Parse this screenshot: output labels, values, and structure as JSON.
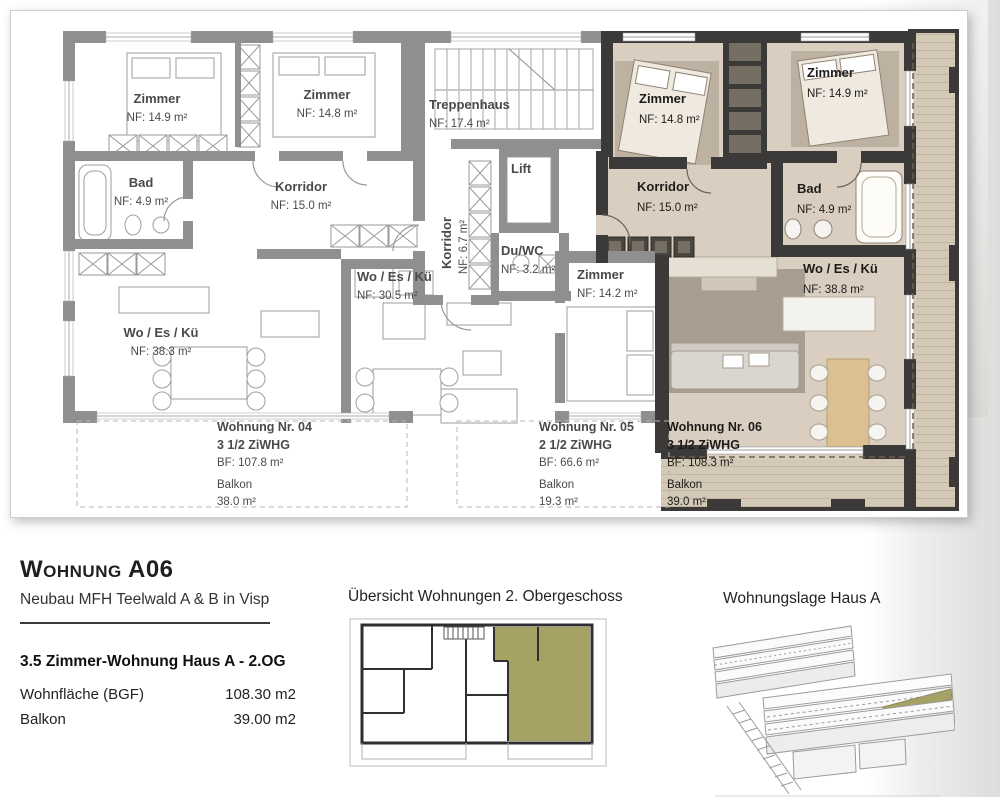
{
  "colors": {
    "wall_gray": "#8f8f8f",
    "wall_dark": "#3b3a38",
    "floor_tan": "#d9cec0",
    "olive": "#a6a263",
    "text_gray": "#4a4a4a",
    "text_dark": "#1d1c1a"
  },
  "plan": {
    "apt04": {
      "zimmer1_name": "Zimmer",
      "zimmer1_nf": "NF: 14.9 m²",
      "zimmer2_name": "Zimmer",
      "zimmer2_nf": "NF: 14.8 m²",
      "bad_name": "Bad",
      "bad_nf": "NF: 4.9 m²",
      "korridor_name": "Korridor",
      "korridor_nf": "NF: 15.0 m²",
      "wek_name": "Wo / Es / Kü",
      "wek_nf": "NF: 38.3 m²",
      "title": "Wohnung Nr. 04",
      "type": "3 1/2 ZiWHG",
      "bf": "BF: 107.8 m²",
      "balkon_label": "Balkon",
      "balkon_nf": "38.0 m²"
    },
    "common": {
      "treppenhaus_name": "Treppenhaus",
      "treppenhaus_nf": "NF: 17.4 m²",
      "lift_name": "Lift",
      "korridor_name": "Korridor",
      "korridor_nf": "NF: 6.7 m²",
      "duwc_name": "Du/WC",
      "duwc_nf": "NF: 3.2 m²"
    },
    "apt05": {
      "wek_name": "Wo / Es / Kü",
      "wek_nf": "NF: 30.5 m²",
      "zimmer_name": "Zimmer",
      "zimmer_nf": "NF: 14.2 m²",
      "title": "Wohnung Nr. 05",
      "type": "2 1/2 ZiWHG",
      "bf": "BF: 66.6 m²",
      "balkon_label": "Balkon",
      "balkon_nf": "19.3 m²"
    },
    "apt06": {
      "zimmer1_name": "Zimmer",
      "zimmer1_nf": "NF: 14.8 m²",
      "zimmer2_name": "Zimmer",
      "zimmer2_nf": "NF: 14.9 m²",
      "korridor_name": "Korridor",
      "korridor_nf": "NF: 15.0 m²",
      "bad_name": "Bad",
      "bad_nf": "NF: 4.9 m²",
      "wek_name": "Wo / Es / Kü",
      "wek_nf": "NF: 38.8 m²",
      "title": "Wohnung Nr. 06",
      "type": "3 1/2 ZiWHG",
      "bf": "BF: 108.3 m²",
      "balkon_label": "Balkon",
      "balkon_nf": "39.0 m²"
    }
  },
  "info": {
    "title": "Wohnung A06",
    "subtitle": "Neubau MFH Teelwald A & B in Visp",
    "heading": "3.5 Zimmer-Wohnung Haus A - 2.OG",
    "rows": [
      {
        "label": "Wohnfläche (BGF)",
        "value": "108.30 m2"
      },
      {
        "label": "Balkon",
        "value": "39.00 m2"
      }
    ]
  },
  "overview": {
    "title": "Übersicht Wohnungen 2. Obergeschoss"
  },
  "location": {
    "title": "Wohnungslage Haus A"
  }
}
